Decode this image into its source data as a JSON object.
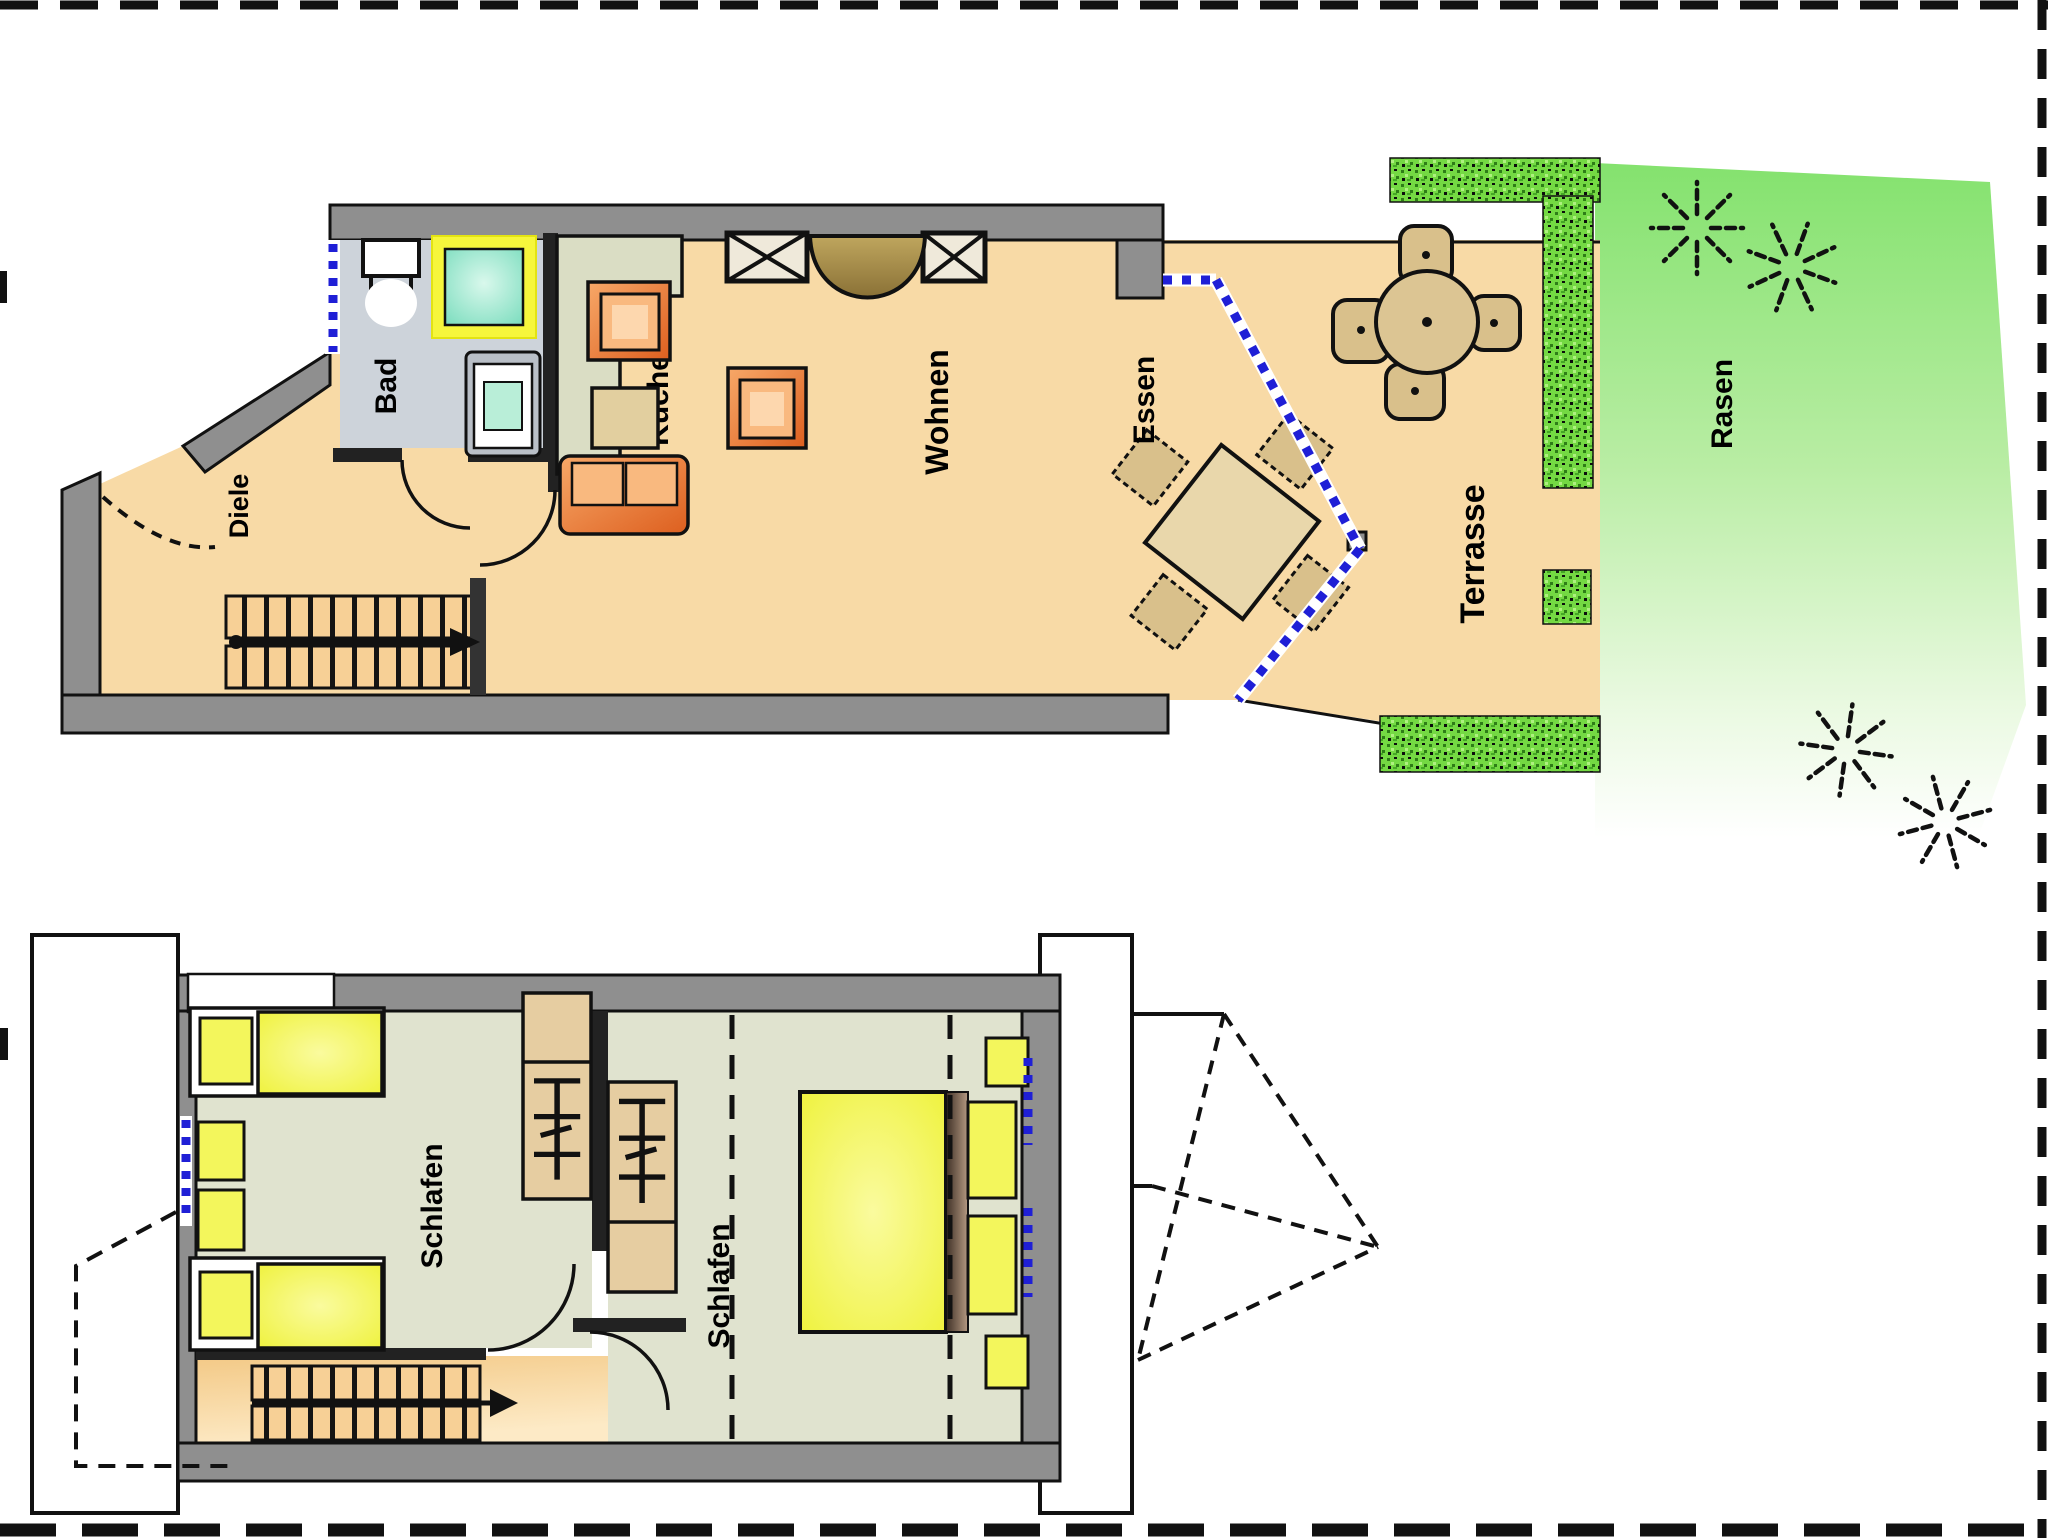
{
  "floor_plan": {
    "upper_floor": {
      "room_labels": {
        "bad": "Bad",
        "diele": "Diele",
        "kueche": "Küche",
        "wohnen": "Wohnen",
        "essen": "Essen"
      },
      "outdoor_labels": {
        "terrasse": "Terrasse",
        "rasen": "Rasen"
      }
    },
    "lower_floor": {
      "room_labels": {
        "schlafen_left": "Schlafen",
        "schlafen_right": "Schlafen"
      }
    },
    "colors": {
      "wall_gray": "#8f8f8f",
      "floor_orange": "#f8daa6",
      "bedroom_floor_green": "#e0e3cf",
      "bath_floor_gray": "#cdd3da",
      "bed_yellow": "#eff23f",
      "furniture_orange": "#e8782f",
      "wood_tan": "#d9c08b",
      "window_blue": "#1f1fd6",
      "hedge_green": "#6fdb3c",
      "lawn_green": "#84e26e",
      "shower_mint": "#9fe7cc",
      "shower_frame_yellow": "#f6f63c"
    }
  }
}
